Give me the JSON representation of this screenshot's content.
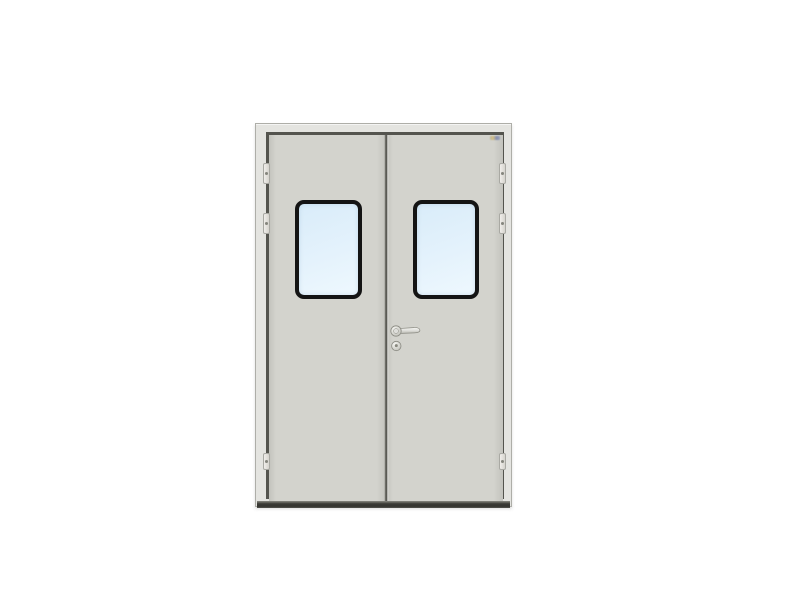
{
  "image": {
    "type": "product-photo",
    "subject": "double-leaf hygienic steel door with vision windows",
    "background_color": "#ffffff"
  },
  "door": {
    "leaves": 2,
    "vision_window_count": 2,
    "hinges_per_side": 3,
    "hardware": {
      "handle": "lever-handle",
      "lock": "cylinder-lock",
      "sticker": "small-brand-label-top-right"
    },
    "colors": {
      "bg": "#ffffff",
      "frame_face": "#e4e4e0",
      "frame_edge": "#aeaea8",
      "gap_line": "#54544e",
      "leaf": "#d3d3cd",
      "leaf_edge_dark": "#c3c3bd",
      "seam_dark": "#5a5a54",
      "seam_light": "#dededa",
      "threshold_dark": "#3b3b36",
      "threshold_light": "#8a8a82",
      "window_frame": "#141414",
      "glass_top": "#d9ecf9",
      "glass_mid": "#e4f2fc",
      "glass_bottom": "#eef8fe",
      "hinge_face": "#f0eeea",
      "hinge_shade": "#d6d4ce",
      "hinge_edge": "#a9a9a3",
      "hinge_pin": "#85857d",
      "metal_light": "#f6f6f2",
      "metal_mid": "#dededa",
      "metal_dark": "#b5b5ad",
      "metal_edge": "#8b8b83",
      "keyhole": "#87877d",
      "sticker_yellow": "#d2bd7d",
      "sticker_blue": "#7d88b0"
    },
    "windows": [
      {
        "leaf": "left",
        "x": 26,
        "y": 65,
        "w": 67,
        "h": 99
      },
      {
        "leaf": "right",
        "x": 27,
        "y": 65,
        "w": 66,
        "h": 99
      }
    ],
    "hinges": {
      "sides": [
        "left",
        "right"
      ],
      "y_offsets": [
        39,
        89,
        329
      ],
      "heights": [
        21,
        21,
        17
      ],
      "left_x": 7,
      "right_x": 243
    }
  }
}
